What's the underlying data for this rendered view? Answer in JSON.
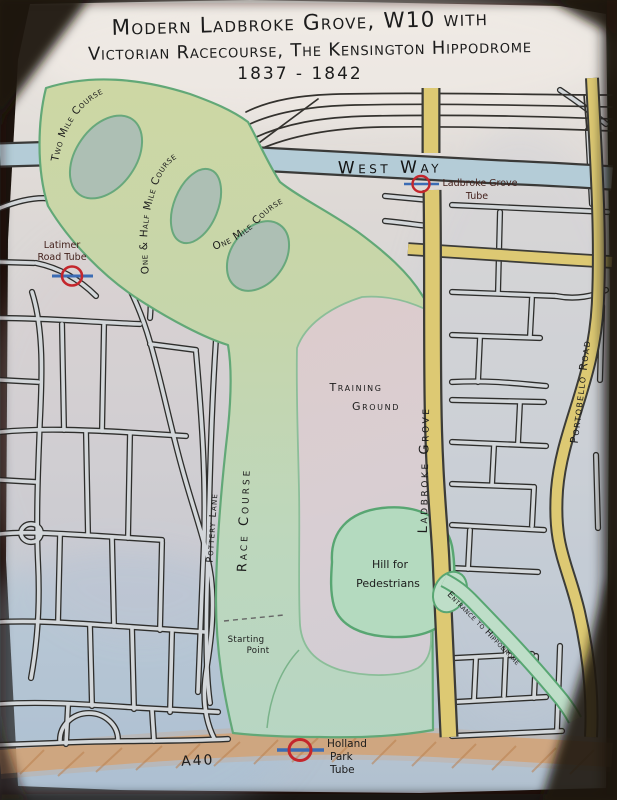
{
  "title": {
    "line1": "Modern Ladbroke Grove, W10 with",
    "line2": "Victorian Racecourse, The Kensington Hippodrome",
    "line3": "1837 - 1842"
  },
  "course_labels": {
    "two_mile": "Two Mile Course",
    "one_and_half_mile": "One & Half Mile Course",
    "one_mile": "One Mile Course"
  },
  "area_labels": {
    "training_ground_line1": "Training",
    "training_ground_line2": "Ground",
    "race_course": "Race Course",
    "hill_line1": "Hill for",
    "hill_line2": "Pedestrians",
    "starting_line1": "Starting",
    "starting_line2": "Point",
    "entrance": "Entrance to Hippodrome"
  },
  "road_labels": {
    "westway": "West Way",
    "ladbroke_grove": "Ladbroke Grove",
    "portobello_road": "Portobello Road",
    "pottery_lane": "Pottery Lane",
    "a40": "A40"
  },
  "tube_stations": {
    "latimer_line1": "Latimer",
    "latimer_line2": "Road Tube",
    "ladbroke_line1": "Ladbroke Grove",
    "ladbroke_line2": "Tube",
    "holland_line1": "Holland",
    "holland_line2": "Park",
    "holland_line3": "Tube"
  },
  "colors": {
    "course_green": "#cdd7a4",
    "course_green_south": "#b7d6c3",
    "course_outline": "#62a877",
    "training_ground_pink": "#dccdd0",
    "hill_green": "#b4dabf",
    "road_yellow": "#ddc973",
    "westway_blue": "#b4ccd7",
    "a40_orange": "#d4a173",
    "roundel_red": "#c4262c",
    "roundel_bar_blue": "#3c6cb4",
    "ink": "#1c1c1c"
  }
}
